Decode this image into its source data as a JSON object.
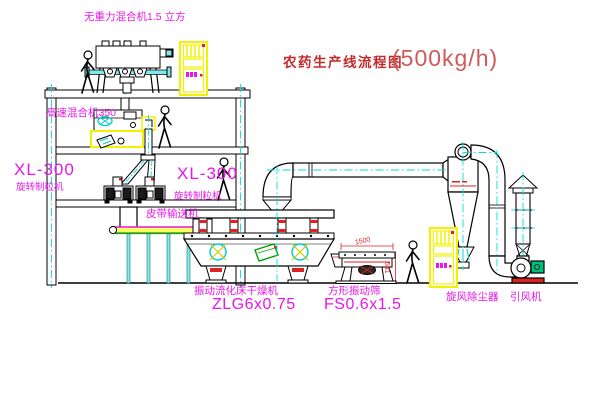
{
  "title": {
    "name": "农药生产线流程图",
    "capacity": "(500kg/h)"
  },
  "equipment_labels": {
    "gravity_mixer": "无重力混合机1.5 立方",
    "high_speed_mixer": "高速混合机350",
    "granulator_left_model": "XL-300",
    "granulator_left_name": "旋转制粒机",
    "granulator_right_model": "XL-300",
    "granulator_right_name": "旋转制粒机",
    "belt_conveyor": "皮带输送机",
    "fluid_bed_dryer_name": "振动流化床干燥机",
    "fluid_bed_dryer_model": "ZLG6x0.75",
    "vibrating_screen_name": "方形振动筛",
    "vibrating_screen_model": "FS0.6x1.5",
    "cyclone": "旋风除尘器",
    "induced_draft_fan": "引风机"
  },
  "dimensions": {
    "screen_length": "1500",
    "screen_height": "541"
  },
  "colors": {
    "label_magenta": "#e816e8",
    "title_red": "#c42a2a",
    "line_black": "#000000",
    "centerline_cyan": "#00dede",
    "highlight_yellow": "#f2f200",
    "accent_red": "#dd2222",
    "motor_green": "#00c080"
  }
}
